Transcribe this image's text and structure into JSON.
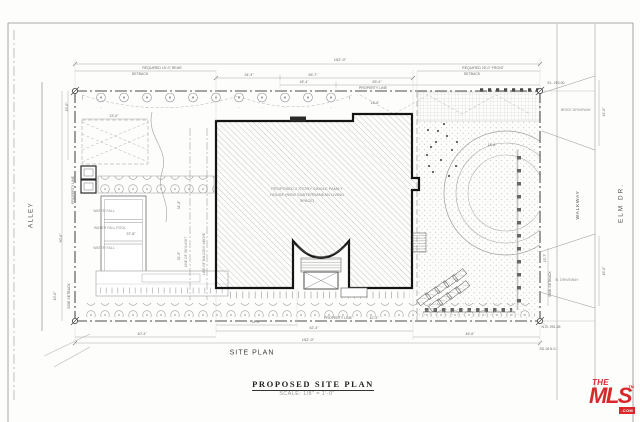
{
  "sheet": {
    "plan_label": "SITE PLAN",
    "title": "PROPOSED SITE PLAN",
    "scale": "SCALE: 1/8\" = 1'-0\""
  },
  "streets": {
    "alley": "ALLEY",
    "walkway": "WALKWAY",
    "elm": "ELM DR."
  },
  "property": {
    "line": "PROPERTY LINE",
    "corner_elevation": "EL. 253.00",
    "natural_grade": "N.G. 251.26",
    "natural_grade_small": "251.26 N.G."
  },
  "setbacks": {
    "rear_line1": "REQUIRED 15'-0\" REAR",
    "front_line1": "REQUIRED 25'-0\" FRONT",
    "setback_word": "SETBACK",
    "side": "SIDE SETBACK"
  },
  "building": {
    "label_line1": "PROPOSED 2 STORY SINGLE FAMILY",
    "label_line2": "HOUSE (NEW SUBTERRANEAN LIVING",
    "label_line3": "SPACE)"
  },
  "features": {
    "water_fall": "WATER FALL",
    "water_fall_pool": "WATER FALL  POOL",
    "brick_driveway": "BRICK  DRIVEWAY",
    "n_driveway": "N.  DRIVEWAY",
    "line_of_skylight": "LINE OF SKYLIGHT",
    "line_of_balcony": "LINE OF BALCONY ABOVE"
  },
  "dims": {
    "overall": "152'-0\"",
    "d34_3": "34'-3\"",
    "d65_7": "65'-7\"",
    "d18_4": "18'-4\"",
    "d83_4": "83'-4\"",
    "d18_6": "18'-6\"",
    "d23_0": "23'-0\"",
    "d15_0": "15'-0\"",
    "d90_6": "90'-6\"",
    "d10_0": "10'-0\"",
    "d37_8": "37'-8\"",
    "d31_4": "31'-4\"",
    "d31_3": "31'-3\"",
    "d14_0": "14'-0\"",
    "d16_0": "16'-0\"",
    "d15_7": "15'-7\"",
    "d34_4": "34'-4\"",
    "d62_4": "62'-4\"",
    "d40_3": "40'-3\"",
    "d45_6": "45'-6\"",
    "d42_4": "42'-4\""
  },
  "logo": {
    "the": "THE",
    "mls": "MLS",
    "tm": "TM",
    "com": ".COM",
    "color": "#d7282c"
  }
}
